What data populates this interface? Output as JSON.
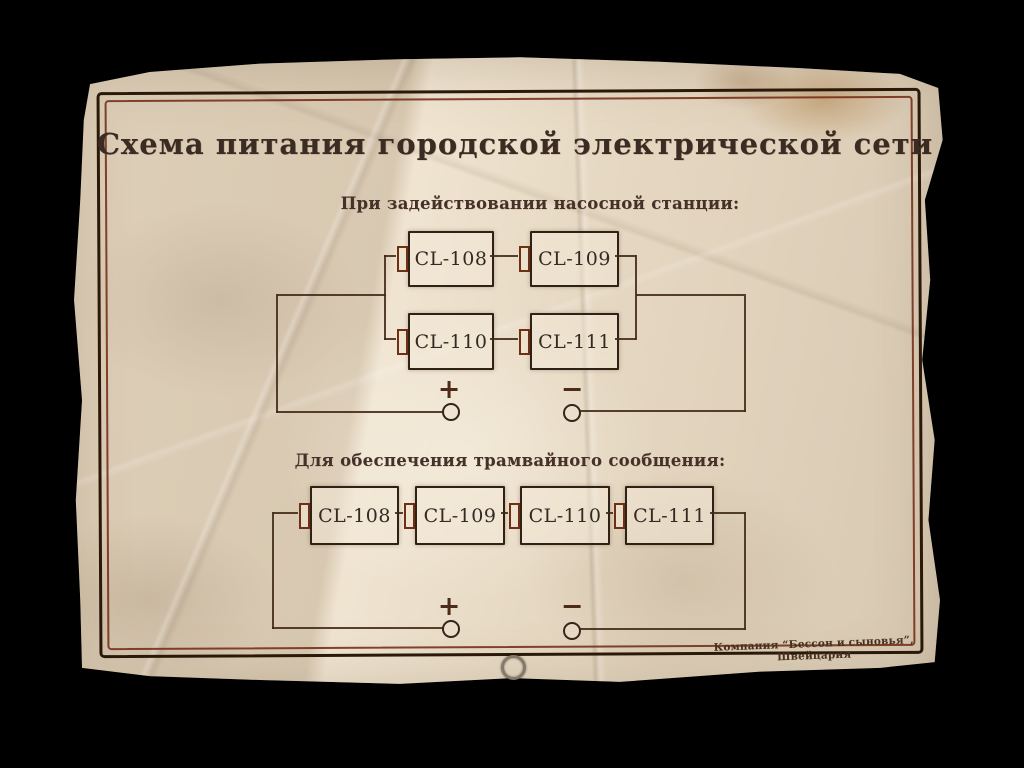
{
  "scene": {
    "background_color": "#000000"
  },
  "paper": {
    "base_color": "#e9dcc6",
    "border_outer_color": "#2a1808",
    "border_inner_color": "#76301a",
    "ink_color": "#35291d",
    "wire_color": "#402816"
  },
  "document": {
    "title": "Схема питания городской электрической сети",
    "sections": [
      {
        "heading": "При задействовании насосной станции:",
        "circuit": "series-parallel",
        "batteries": [
          "CL-108",
          "CL-109",
          "CL-110",
          "CL-111"
        ],
        "terminal_plus": "+",
        "terminal_minus": "−"
      },
      {
        "heading": "Для обеспечения трамвайного сообщения:",
        "circuit": "series",
        "batteries": [
          "CL-108",
          "CL-109",
          "CL-110",
          "CL-111"
        ],
        "terminal_plus": "+",
        "terminal_minus": "−"
      }
    ],
    "footer": "Компания “Бессон и сыновья”, Швейцария"
  }
}
